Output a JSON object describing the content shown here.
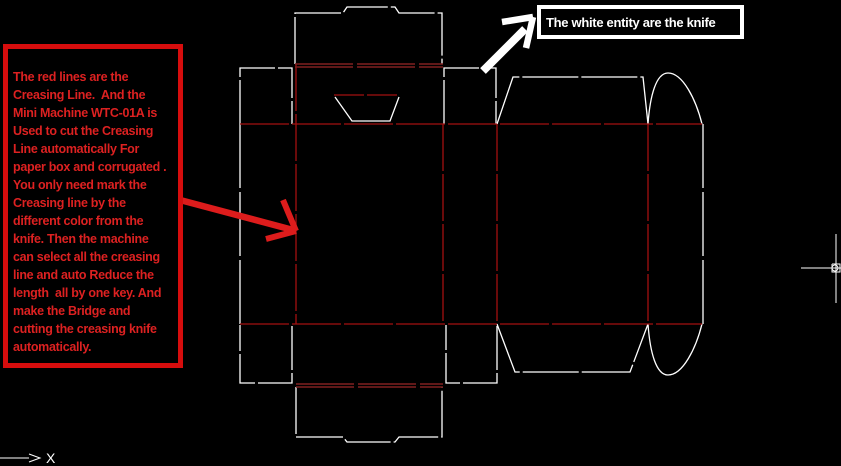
{
  "notes": {
    "creasing": {
      "text": "The red lines are the\nCreasing Line.  And the\nMini Machine WTC-01A is\nUsed to cut the Creasing\nLine automatically For\npaper box and corrugated .\nYou only need mark the\nCreasing line by the\ndifferent color from the\nknife. Then the machine\ncan select all the creasing\nline and auto Reduce the\nlength  all by one key. And\nmake the Bridge and\ncutting the creasing knife\nautomatically."
    },
    "knife": {
      "text": "The white entity are the knife"
    }
  },
  "ucs": {
    "x_label": "X"
  },
  "colors": {
    "background": "#000000",
    "knife": "#ffffff",
    "crease": "#a31010",
    "crease2": "#802020",
    "red_arrow": "#dd1c1c",
    "white_arrow": "#ffffff",
    "cursor": "#ffffff",
    "note_border": "#d60d0d",
    "note_text": "#dd2121"
  },
  "drawing": {
    "viewbox": "0 0 841 466",
    "segments": [
      {
        "name": "top-tuck-flap-cut",
        "kind": "knife",
        "type": "polyline",
        "points": "295,64 295,13 343,13 347,7 395,7 399,13 442,13 442,64",
        "dash": "47 3"
      },
      {
        "name": "top-left-dust-flap-cut",
        "kind": "knife",
        "type": "polyline",
        "points": "240,124 240,68 292,68 292,124",
        "dash": "44 3"
      },
      {
        "name": "top-right-dust-flap-cut",
        "kind": "knife",
        "type": "polyline",
        "points": "444,124 444,68 496,68 496,124",
        "dash": "44 3"
      },
      {
        "name": "top-back-dust-flap-cut",
        "kind": "knife",
        "type": "polyline",
        "points": "497,124 513,77 643,77 648,124",
        "dash": "56 3"
      },
      {
        "name": "glue-flap-top-curve",
        "kind": "knife",
        "type": "path",
        "d": "M648,124 C650,96 656,73 668,73 C683,73 696,100 702,124"
      },
      {
        "name": "glue-flap-right-edge",
        "kind": "knife",
        "type": "polyline",
        "points": "703,124 703,324",
        "dash": "64 4"
      },
      {
        "name": "glue-flap-bottom-curve",
        "kind": "knife",
        "type": "path",
        "d": "M648,324 C650,352 656,375 668,375 C683,375 696,348 702,324"
      },
      {
        "name": "bottom-back-dust-flap-cut",
        "kind": "knife",
        "type": "polyline",
        "points": "497,324 515,372 630,372 648,324",
        "dash": "56 3"
      },
      {
        "name": "bottom-right-dust-flap-cut",
        "kind": "knife",
        "type": "polyline",
        "points": "497,326 497,383 446,383 446,325",
        "dash": "44 3"
      },
      {
        "name": "bottom-left-dust-flap-cut",
        "kind": "knife",
        "type": "polyline",
        "points": "292,326 292,383 240,383 240,325",
        "dash": "44 3"
      },
      {
        "name": "left-panel-edge-cut",
        "kind": "knife",
        "type": "polyline",
        "points": "240,124 240,325",
        "dash": "64 4"
      },
      {
        "name": "bottom-tuck-flap-cut",
        "kind": "knife",
        "type": "polyline",
        "points": "296,387 296,437 343,437 347,442 395,442 399,437 442,437 442,387",
        "dash": "47 3"
      },
      {
        "name": "thumb-notch-cut",
        "kind": "knife",
        "type": "polyline",
        "points": "335,97 352,121 390,121 399,97"
      },
      {
        "name": "top-fold-crease",
        "kind": "crease",
        "type": "polyline",
        "points": "240,124 702,124",
        "dash": "49 3"
      },
      {
        "name": "bottom-fold-crease",
        "kind": "crease",
        "type": "polyline",
        "points": "240,324 702,324",
        "dash": "49 3"
      },
      {
        "name": "front-left-vertical-crease",
        "kind": "crease",
        "type": "polyline",
        "points": "296,64 296,324",
        "dash": "47 3"
      },
      {
        "name": "front-right-vertical-crease",
        "kind": "crease",
        "type": "polyline",
        "points": "443,124 443,324",
        "dash": "47 3"
      },
      {
        "name": "back-left-vertical-crease",
        "kind": "crease",
        "type": "polyline",
        "points": "497,124 497,324",
        "dash": "47 3"
      },
      {
        "name": "glue-vertical-crease",
        "kind": "crease",
        "type": "polyline",
        "points": "648,124 648,324",
        "dash": "47 3"
      },
      {
        "name": "top-tuck-crease-upper",
        "kind": "crease2",
        "type": "polyline",
        "points": "295,64 443,64",
        "dash": "58 4",
        "w": 1.6
      },
      {
        "name": "top-tuck-crease-lower",
        "kind": "crease2",
        "type": "polyline",
        "points": "295,67 443,67",
        "dash": "58 4",
        "w": 1.6
      },
      {
        "name": "bottom-tuck-crease-upper",
        "kind": "crease2",
        "type": "polyline",
        "points": "296,384 443,384",
        "dash": "58 4",
        "w": 1.6
      },
      {
        "name": "bottom-tuck-crease-lower",
        "kind": "crease2",
        "type": "polyline",
        "points": "296,387 443,387",
        "dash": "58 4",
        "w": 1.6
      },
      {
        "name": "thumb-notch-crease",
        "kind": "crease",
        "type": "polyline",
        "points": "334,95 400,95",
        "dash": "30 3"
      },
      {
        "name": "red-arrow-shaft",
        "kind": "red_arrow",
        "type": "polyline",
        "points": "180,200 293,230",
        "w": 6.5
      },
      {
        "name": "red-arrow-head-upper-barb",
        "kind": "red_arrow",
        "type": "polyline",
        "points": "283,200 296,231",
        "w": 6
      },
      {
        "name": "red-arrow-head-lower-barb",
        "kind": "red_arrow",
        "type": "polyline",
        "points": "266,239 296,231",
        "w": 6
      },
      {
        "name": "white-arrow-shaft",
        "kind": "white_arrow",
        "type": "polyline",
        "points": "483,71 525,29",
        "w": 8
      },
      {
        "name": "white-arrow-head-left-barb",
        "kind": "white_arrow",
        "type": "polyline",
        "points": "502,22 533,17",
        "w": 6.5
      },
      {
        "name": "white-arrow-head-down-barb",
        "kind": "white_arrow",
        "type": "polyline",
        "points": "533,17 526,48",
        "w": 6.5
      },
      {
        "name": "crosshair-horizontal",
        "kind": "cursor",
        "type": "polyline",
        "points": "801,268 841,268",
        "w": 1
      },
      {
        "name": "crosshair-vertical",
        "kind": "cursor",
        "type": "polyline",
        "points": "836,234 836,303",
        "w": 1
      },
      {
        "name": "crosshair-pickbox",
        "kind": "cursor",
        "type": "polyline",
        "points": "832,264 840,264 840,272 832,272 832,264",
        "w": 1
      },
      {
        "name": "crosshair-snap-circle",
        "kind": "cursor",
        "type": "circle",
        "cx": 835,
        "cy": 268,
        "r": 3,
        "w": 1
      },
      {
        "name": "ucs-x-axis-line",
        "kind": "cursor",
        "type": "polyline",
        "points": "0,458 29,458",
        "w": 1
      },
      {
        "name": "ucs-x-arrowhead",
        "kind": "cursor",
        "type": "polyline",
        "points": "29,454 40,458 29,462",
        "w": 1
      }
    ]
  }
}
